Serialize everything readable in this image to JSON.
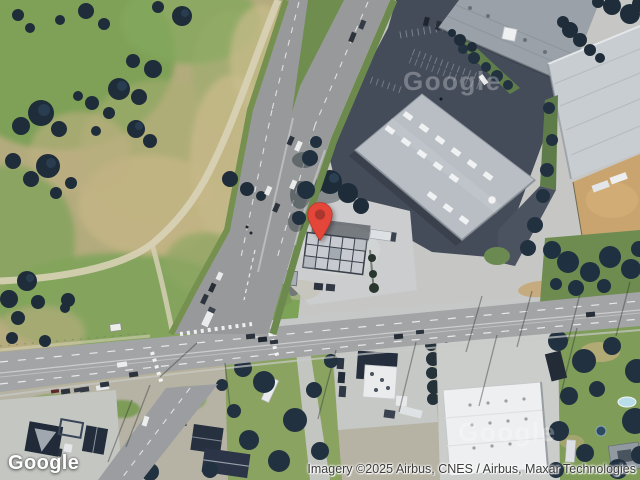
{
  "map": {
    "logo": "Google",
    "watermark": "Google",
    "attribution": "Imagery ©2025 Airbus, CNES / Airbus, Maxar Technologies",
    "pin": {
      "body_color": "#E5463A",
      "dot_color": "#AA362D"
    }
  }
}
